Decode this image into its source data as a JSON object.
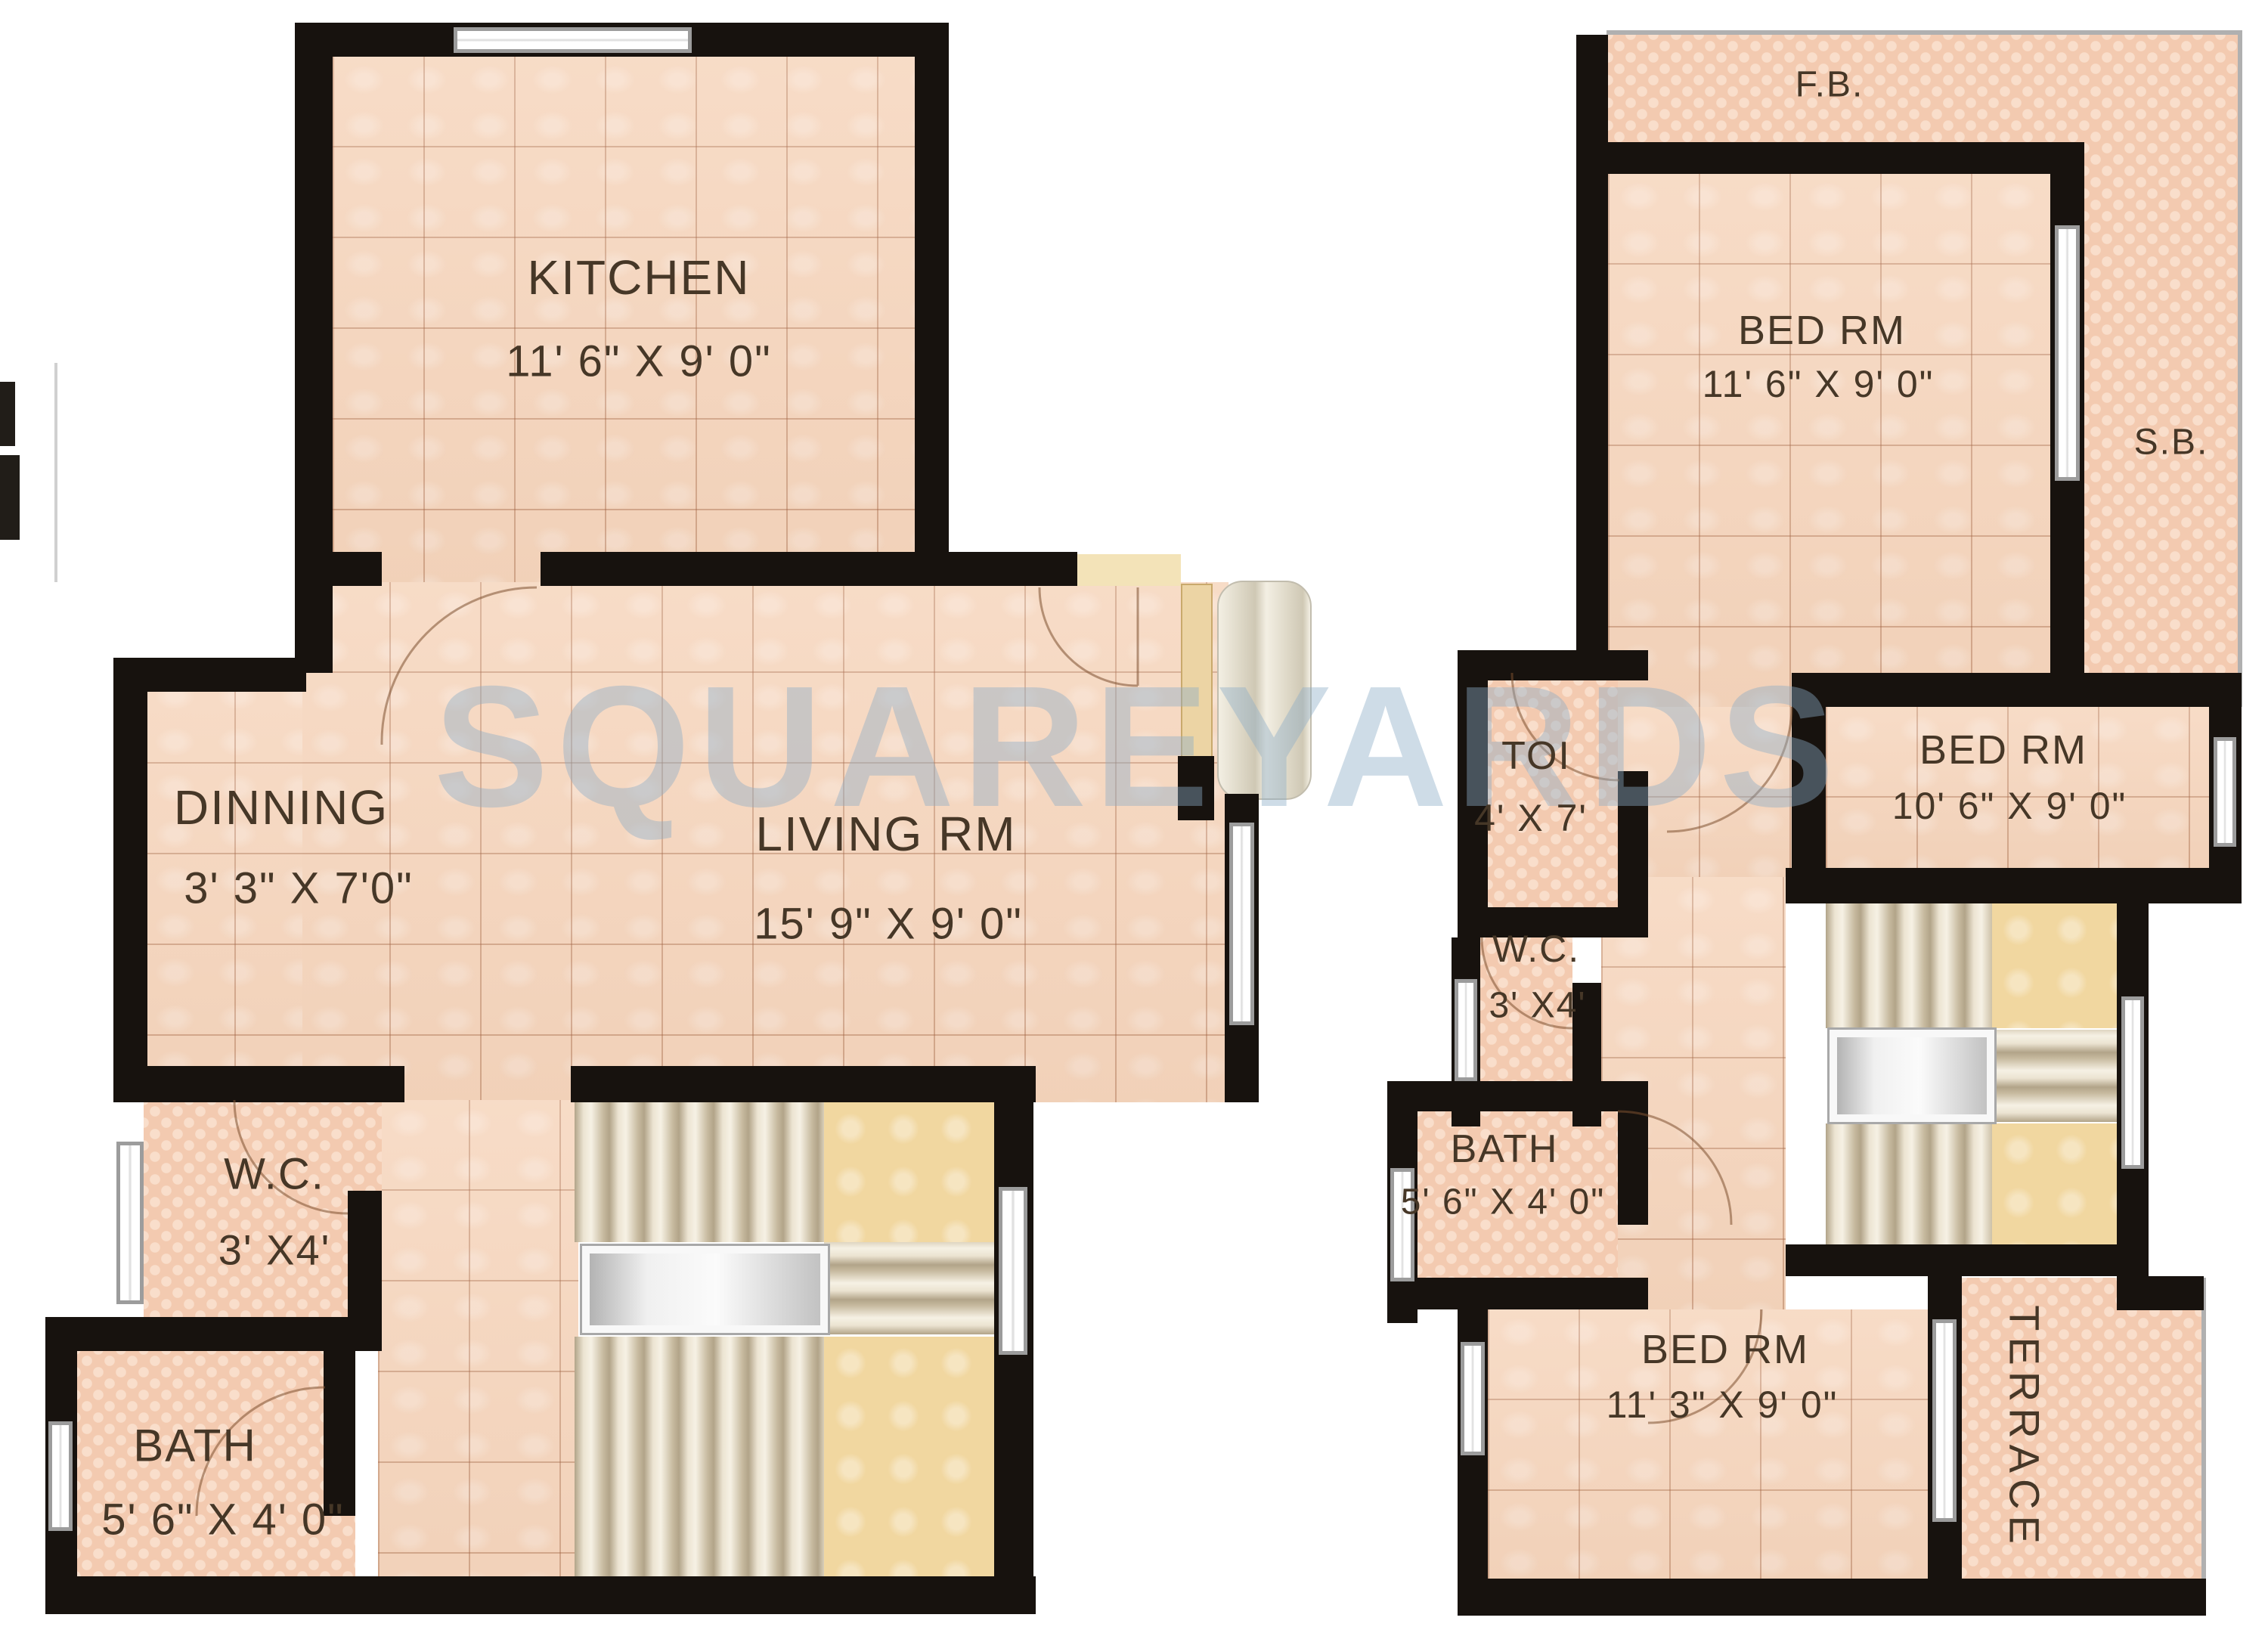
{
  "watermark": "SQUAREYARDS",
  "left_plan": {
    "kitchen": {
      "name": "KITCHEN",
      "dims": "11' 6\" X 9' 0\""
    },
    "dinning": {
      "name": "DINNING",
      "dims": "3' 3\" X 7'0\""
    },
    "living": {
      "name": "LIVING RM",
      "dims": "15' 9\" X 9' 0\""
    },
    "wc": {
      "name": "W.C.",
      "dims": "3' X4'"
    },
    "bath": {
      "name": "BATH",
      "dims": "5' 6\" X 4' 0\""
    }
  },
  "right_plan": {
    "fb": {
      "name": "F.B."
    },
    "sb": {
      "name": "S.B."
    },
    "bed1": {
      "name": "BED RM",
      "dims": "11' 6\" X 9' 0\""
    },
    "bed2": {
      "name": "BED RM",
      "dims": "10' 6\" X 9' 0\""
    },
    "toi": {
      "name": "TOI",
      "dims": "4' X 7'"
    },
    "wc": {
      "name": "W.C.",
      "dims": "3' X4'"
    },
    "bath": {
      "name": "BATH",
      "dims": "5' 6\" X 4' 0\""
    },
    "bed3": {
      "name": "BED RM",
      "dims": "11' 3\" X 9' 0\""
    },
    "terrace": {
      "name": "TERRACE"
    }
  },
  "colors": {
    "wall": "#17120e",
    "floor": "#f6d5bc",
    "checker": "#f3cab0",
    "checkerDot": "#f9decb",
    "accent": "#f1d7a0",
    "label": "#463727",
    "watermark": "#8dadc7",
    "window": "#ffffff",
    "doorArc": "#7d5030"
  }
}
